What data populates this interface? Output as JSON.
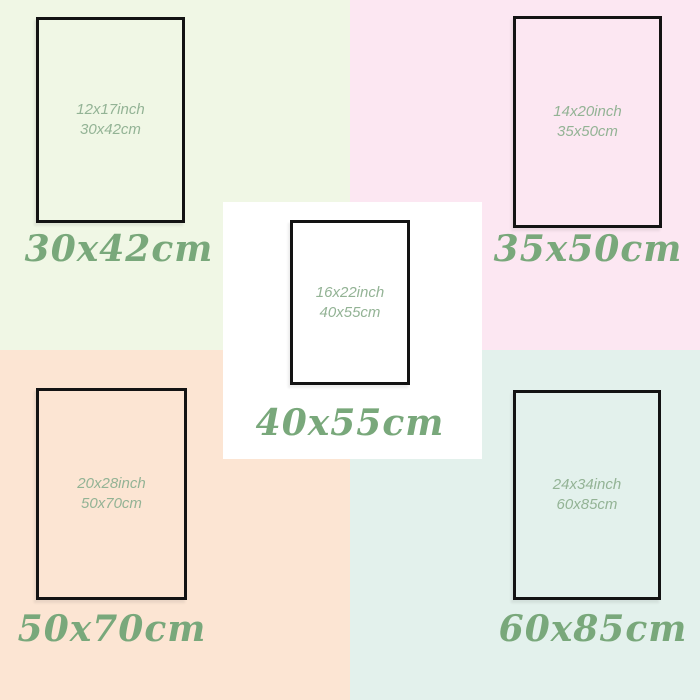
{
  "title": "Poster size comparison chart",
  "colors": {
    "frame_border": "#131313",
    "inner_text": "#93b395",
    "label_text": "#79a87b",
    "panel_green": "#f0f7e5",
    "panel_pink": "#fce7f2",
    "panel_peach": "#fce5d3",
    "panel_mint": "#e3f1ec",
    "panel_white": "#ffffff"
  },
  "sizes": [
    {
      "inch": "12x17inch",
      "cm": "30x42cm",
      "label": "30x42cm",
      "panel_bg": "#f0f7e5"
    },
    {
      "inch": "14x20inch",
      "cm": "35x50cm",
      "label": "35x50cm",
      "panel_bg": "#fce7f2"
    },
    {
      "inch": "20x28inch",
      "cm": "50x70cm",
      "label": "50x70cm",
      "panel_bg": "#fce5d3"
    },
    {
      "inch": "24x34inch",
      "cm": "60x85cm",
      "label": "60x85cm",
      "panel_bg": "#e3f1ec"
    },
    {
      "inch": "16x22inch",
      "cm": "40x55cm",
      "label": "40x55cm",
      "panel_bg": "#ffffff"
    }
  ]
}
